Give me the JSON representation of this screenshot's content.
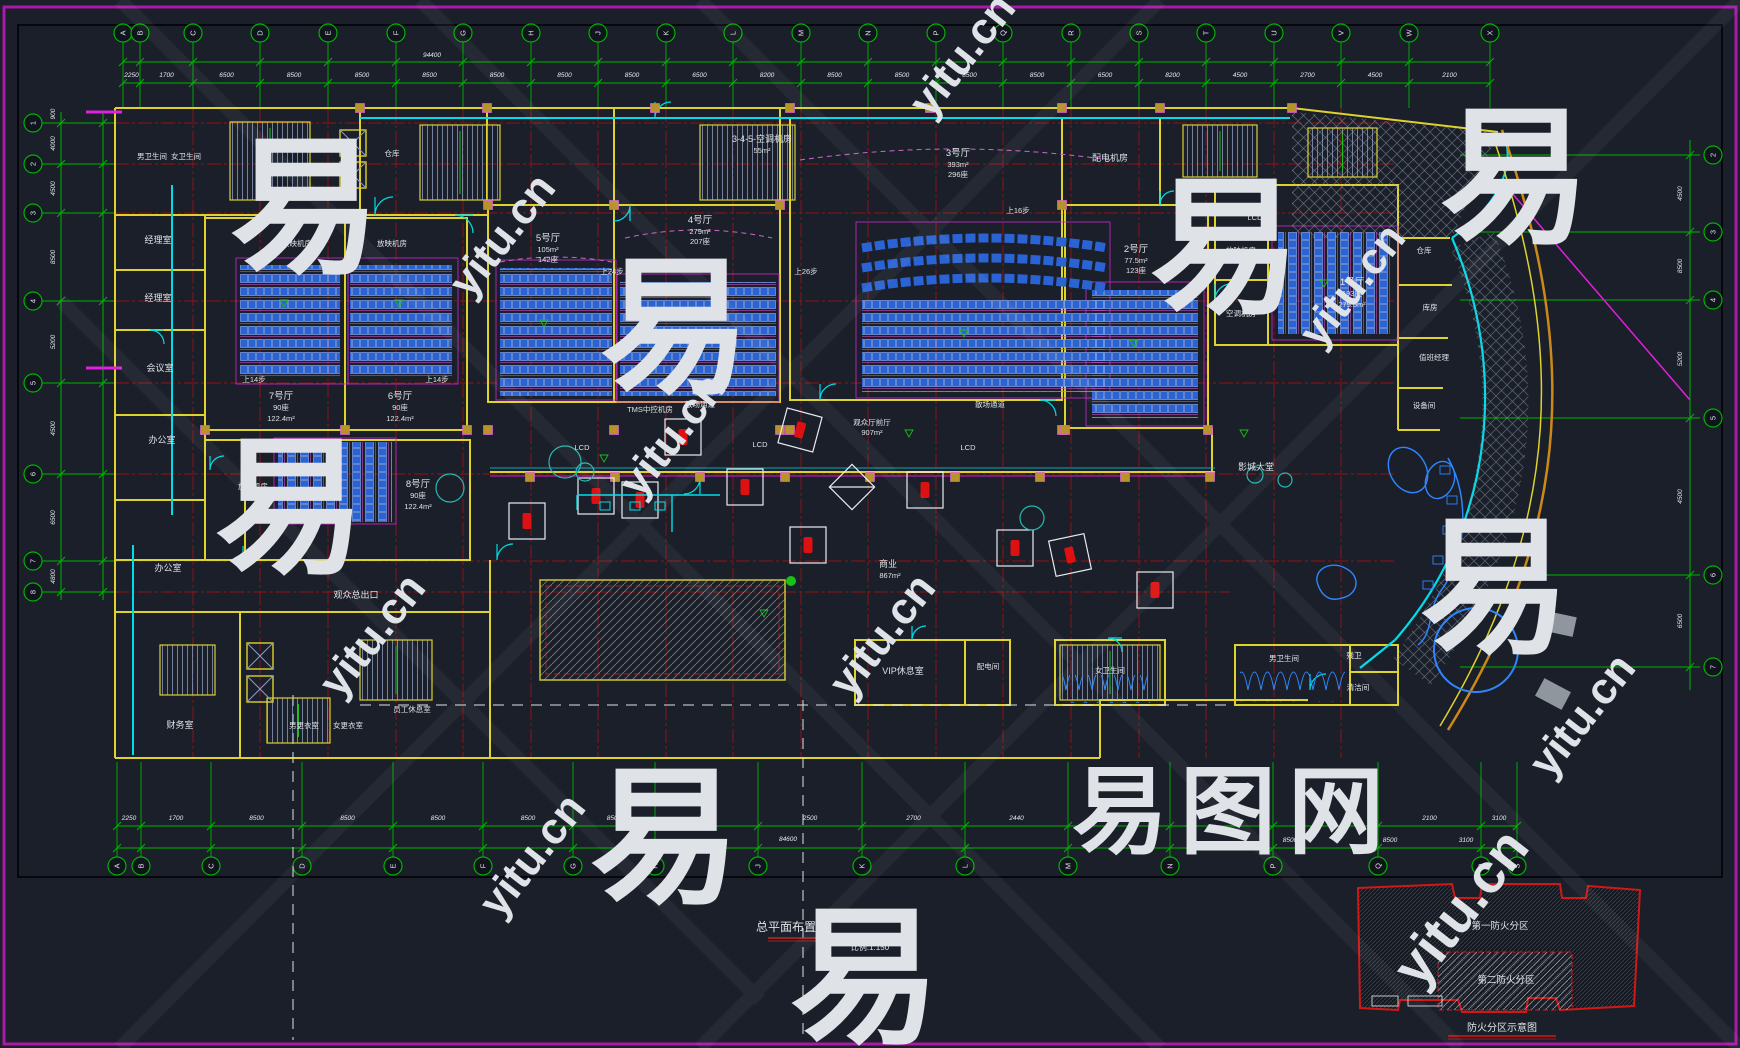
{
  "title_block": {
    "title": "总平面布置图",
    "scale": "比例:1:150"
  },
  "fire_diagram": {
    "zone1": "第一防火分区",
    "zone2": "第二防火分区",
    "caption": "防火分区示意图"
  },
  "watermark": {
    "brand": "易图网",
    "site": "yitu.cn",
    "glyph": "易"
  },
  "halls": {
    "h1": {
      "name": "1号厅",
      "seats": "193座",
      "area": "279.5m²"
    },
    "h2": {
      "name": "2号厅",
      "seats": "123座",
      "area": "77.5m²"
    },
    "h3": {
      "name": "3号厅",
      "area": "393m²",
      "seats": "296座"
    },
    "h4": {
      "name": "4号厅",
      "area": "279m²",
      "seats": "207座"
    },
    "h5": {
      "name": "5号厅",
      "area": "105m²",
      "seats": "142座"
    },
    "h6": {
      "name": "6号厅",
      "seats": "90座",
      "area": "122.4m²"
    },
    "h7": {
      "name": "7号厅",
      "seats": "90座",
      "area": "122.4m²"
    },
    "h8": {
      "name": "8号厅",
      "seats": "90座",
      "area": "122.4m²"
    }
  },
  "rooms": {
    "ac_345": "3-4-5-空调机房",
    "ac_345_area": "55m²",
    "power_room": "配电机房",
    "proj_room": "放映机房",
    "ac_room": "空调机房",
    "tms_room": "TMS中控机房",
    "mens_wc": "男卫生间",
    "womens_wc": "女卫生间",
    "storage": "仓库",
    "storeroom": "库房",
    "duty_manager": "值班经理",
    "equipment": "设备间",
    "manager": "经理室",
    "meeting": "会议室",
    "office": "办公室",
    "finance": "财务室",
    "men_locker": "男更衣室",
    "women_locker": "女更衣室",
    "staff_rest": "员工休息室",
    "exit_corridor": "观众总出口",
    "front_hall": "观众厅前厅",
    "front_hall_area": "907m²",
    "lobby": "影城大堂",
    "commerce": "商业",
    "commerce_area": "867m²",
    "vip": "VIP休息室",
    "dist_room": "配电间",
    "acc_wc": "残卫",
    "cleaning": "清洁间"
  },
  "annotations": {
    "up14": "上14步",
    "up16": "上16步",
    "up24": "上24步",
    "up26": "上26步",
    "lcd": "LCD",
    "aisle": "散场通道"
  },
  "grid": {
    "top_labels": [
      "A",
      "B",
      "C",
      "D",
      "E",
      "F",
      "G",
      "H",
      "J",
      "K",
      "L",
      "M",
      "N",
      "P",
      "Q",
      "R",
      "S",
      "T",
      "U",
      "V",
      "W",
      "X"
    ],
    "top_dims": [
      "2250",
      "1700",
      "6500",
      "8500",
      "8500",
      "8500",
      "8500",
      "8500",
      "8500",
      "6500",
      "8200",
      "8500",
      "8500",
      "8500",
      "8500",
      "6500",
      "8200",
      "4500",
      "2700",
      "4500",
      "2100"
    ],
    "top_total": "94400",
    "bottom_labels": [
      "A",
      "B",
      "C",
      "D",
      "E",
      "F",
      "G",
      "H",
      "J",
      "K",
      "L",
      "M",
      "N",
      "P",
      "Q",
      "R",
      "S"
    ],
    "bottom_dims": [
      "2250",
      "1700",
      "8500",
      "8500",
      "8500",
      "8500",
      "8500",
      "8500",
      "2500",
      "2700",
      "2440",
      "6200",
      "8500",
      "1500",
      "2100",
      "3100"
    ],
    "bottom_dims2": [
      "8500",
      "8500",
      "3100"
    ],
    "bottom_total": "84600",
    "left_labels": [
      "1",
      "2",
      "3",
      "4",
      "5",
      "6",
      "7",
      "8"
    ],
    "left_dims": [
      "4000",
      "4500",
      "8500",
      "5200",
      "4500",
      "6500",
      "4800"
    ],
    "left_dim_top": "900",
    "right_labels": [
      "2",
      "3",
      "4",
      "5",
      "6",
      "7"
    ],
    "right_dims": [
      "4500",
      "8500",
      "5200",
      "4500",
      "6500"
    ]
  }
}
